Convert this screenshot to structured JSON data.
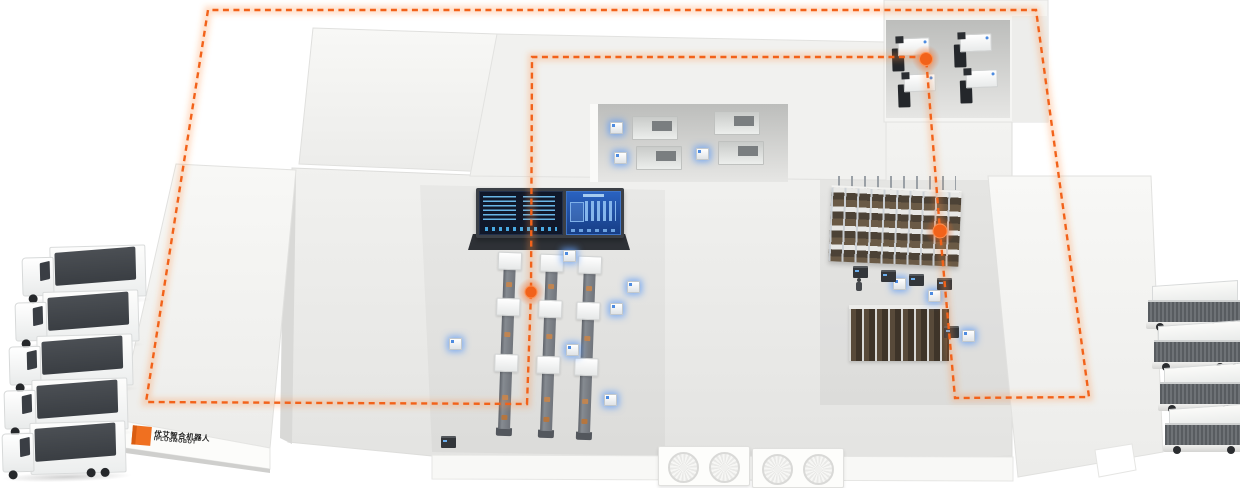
{
  "brand": {
    "logo_text_zh": "优艾智合机器人",
    "logo_text_en": "IPLUSMOBOT",
    "logo_mark_color": "#f07020"
  },
  "palette": {
    "route_orange": "#f2621a",
    "agv_glow_blue": "#5b9cf5",
    "building_shell": "#f2f2f0",
    "floor_gray": "#e7e7e5",
    "dashboard_screen_dark": "#10182a",
    "dashboard_screen_blue": "#1d4fa0",
    "rack_shelf_brown": "#55483a",
    "truck_roof_gray": "#45484c"
  },
  "scene": {
    "type": "isometric-smart-factory-illustration",
    "route": {
      "style": "orange-dashed-loop",
      "waypoint_count": 3
    },
    "counts": {
      "trucks_left": 5,
      "container_trailers_right": 4,
      "production_lines": 3,
      "machining_stations_top_right": 4,
      "workstations_top_middle": 4,
      "glowing_agvs": 12,
      "docked_dark_agvs": 6,
      "hvac_pads": 2,
      "rack_rows": 2
    }
  }
}
